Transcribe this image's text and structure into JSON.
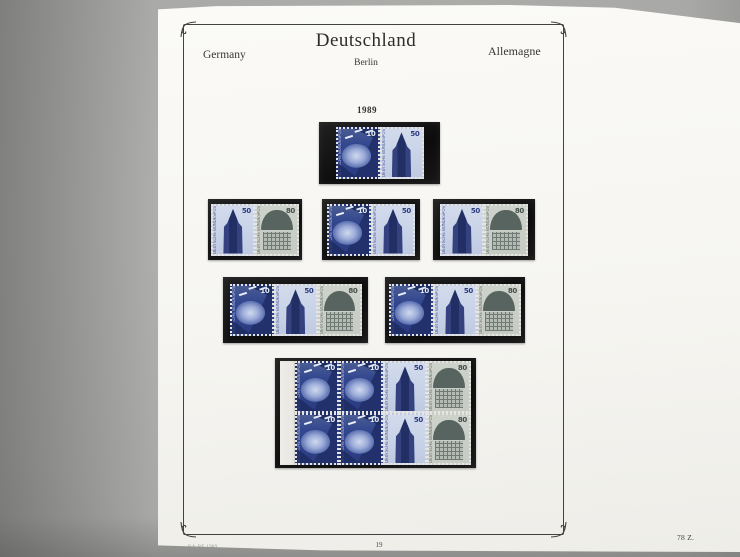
{
  "header": {
    "country_title": "Deutschland",
    "left_label": "Germany",
    "right_label": "Allemagne",
    "region_subtitle": "Berlin"
  },
  "year_label": "1989",
  "stamps": {
    "inscription": "DEUTSCHE BUNDESPOST BERLIN",
    "types": {
      "sculpture": {
        "value": "10",
        "subject": "blue-sculpture-with-gulls",
        "color": "#33478f"
      },
      "tower": {
        "value": "50",
        "subject": "gothic-cathedral-tower",
        "color": "#2c3b7e"
      },
      "interior": {
        "value": "80",
        "subject": "grey-vaulted-hall-interior",
        "color": "#58645f"
      }
    }
  },
  "mounts": [
    {
      "row": 1,
      "format": "horizontal pair",
      "stamps": [
        "sculpture 10",
        "tower 50"
      ]
    },
    {
      "row": 2,
      "format": "horizontal pair",
      "stamps": [
        "tower 50",
        "interior 80"
      ]
    },
    {
      "row": 2,
      "format": "horizontal pair",
      "stamps": [
        "sculpture 10",
        "tower 50"
      ]
    },
    {
      "row": 2,
      "format": "horizontal pair",
      "stamps": [
        "tower 50",
        "interior 80"
      ]
    },
    {
      "row": 3,
      "format": "horizontal strip of 3",
      "stamps": [
        "sculpture 10",
        "tower 50",
        "interior 80"
      ]
    },
    {
      "row": 3,
      "format": "horizontal strip of 3",
      "stamps": [
        "sculpture 10",
        "tower 50",
        "interior 80"
      ]
    },
    {
      "row": 4,
      "format": "booklet pane 4x2 with left selvage",
      "stamps_top": [
        "sculpture 10",
        "sculpture 10",
        "tower 50",
        "interior 80"
      ],
      "stamps_bottom": [
        "sculpture 10",
        "sculpture 10",
        "tower 50",
        "interior 80"
      ]
    }
  ],
  "footer": {
    "page_number": "19",
    "sheet_ref": "78 Z.",
    "brand_mark": "KA-BE 1989"
  },
  "colors": {
    "photo_background": "#a4a4a2",
    "page_paper": "#f7f6f2",
    "mount_black": "#131313",
    "frame_line": "#44423f"
  }
}
